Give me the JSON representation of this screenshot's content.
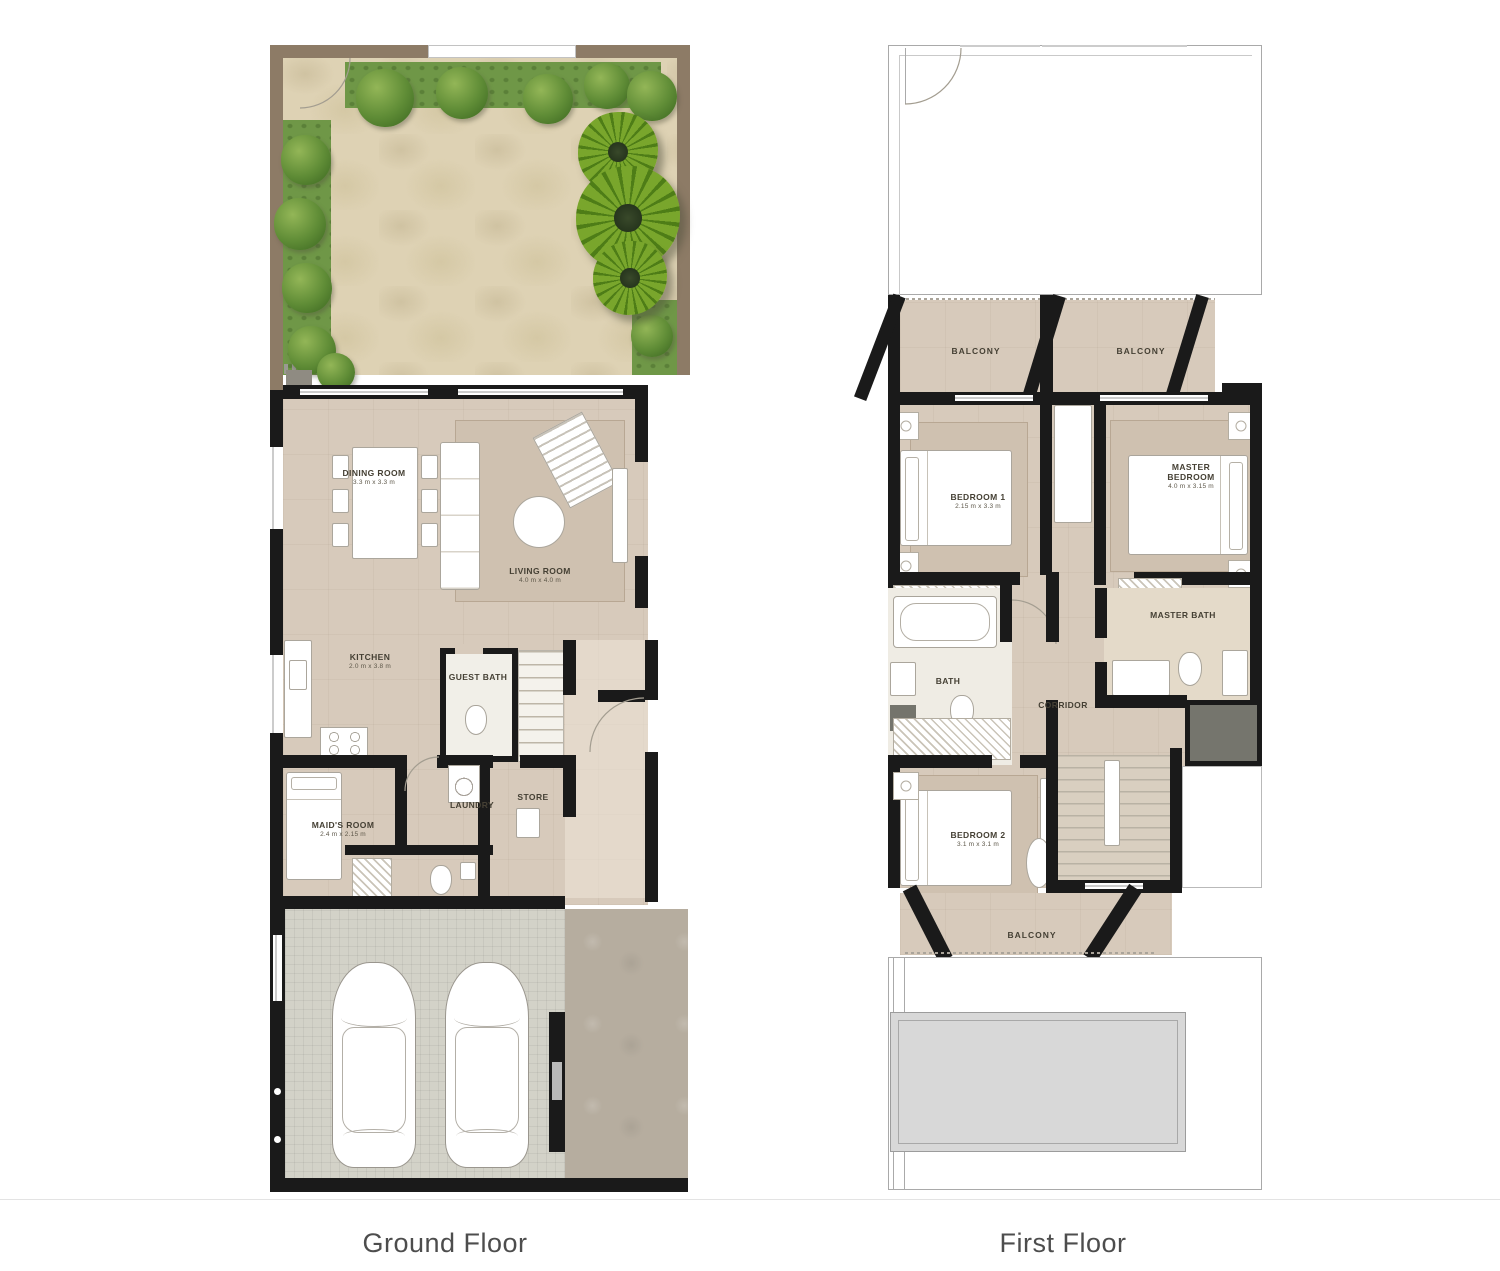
{
  "captions": {
    "ground": "Ground Floor",
    "first": "First Floor"
  },
  "ground_floor": {
    "rooms": {
      "dining": {
        "name": "DINING ROOM",
        "dims": "3.3 m x 3.3 m"
      },
      "living": {
        "name": "LIVING ROOM",
        "dims": "4.0 m x 4.0 m"
      },
      "kitchen": {
        "name": "KITCHEN",
        "dims": "2.0 m x 3.8 m"
      },
      "guest_bath": {
        "name": "GUEST BATH"
      },
      "maids": {
        "name": "MAID'S ROOM",
        "dims": "2.4 m x 2.15 m"
      },
      "laundry": {
        "name": "LAUNDRY"
      },
      "store": {
        "name": "STORE"
      }
    }
  },
  "first_floor": {
    "rooms": {
      "balcony_left": {
        "name": "BALCONY"
      },
      "balcony_right": {
        "name": "BALCONY"
      },
      "bedroom1": {
        "name": "BEDROOM 1",
        "dims": "2.15 m x 3.3 m"
      },
      "master_bedroom": {
        "name": "MASTER BEDROOM",
        "dims": "4.0 m x 3.15 m"
      },
      "bath": {
        "name": "BATH"
      },
      "corridor": {
        "name": "CORRIDOR"
      },
      "master_bath": {
        "name": "MASTER BATH"
      },
      "bedroom2": {
        "name": "BEDROOM 2",
        "dims": "3.1 m x 3.1 m"
      },
      "balcony_bottom": {
        "name": "BALCONY"
      }
    }
  },
  "colors": {
    "wall": "#1a1a1a",
    "floor_beige": "#d7cabb",
    "patio_tan": "#ded2b4",
    "garden_green": "#6f9747",
    "tree_green": "#5f8c36",
    "palm_green": "#79a62c",
    "garage_paving": "#d3d2c8",
    "driveway": "#b6ad9f",
    "fixture_white": "#ffffff",
    "slab_gray": "#d8d8d8",
    "label_text": "#454034",
    "caption_text": "#4d4d4d"
  }
}
